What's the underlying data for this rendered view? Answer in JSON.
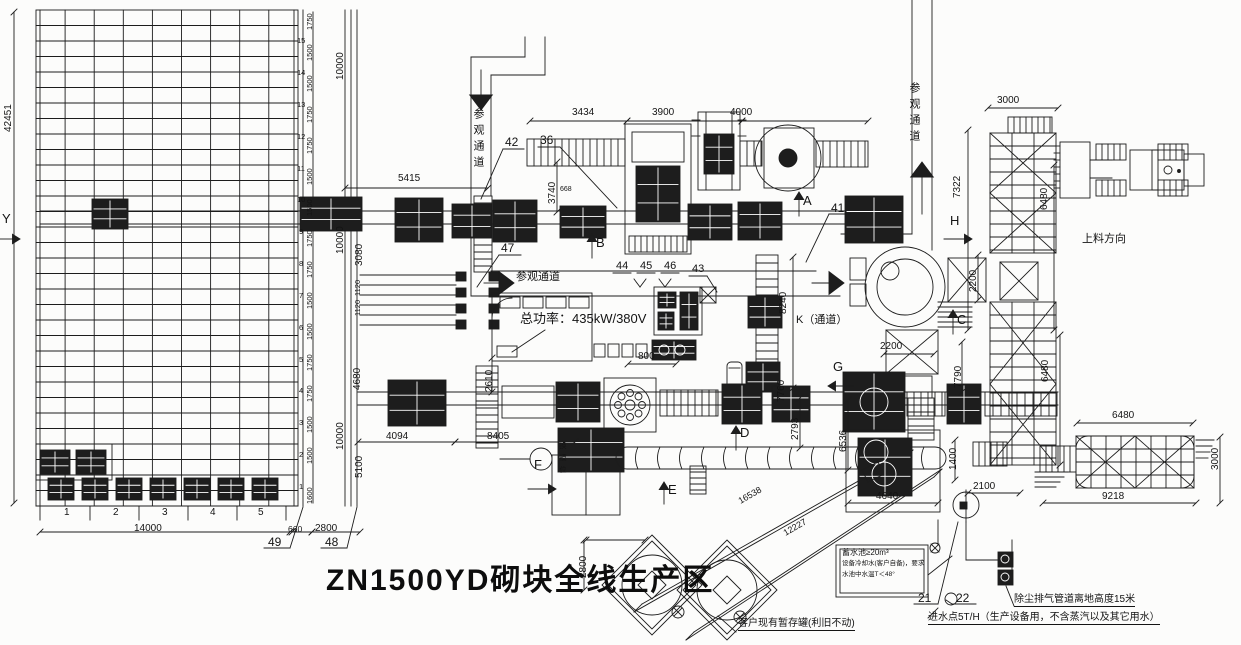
{
  "title": {
    "text": "ZN1500YD砌块全线生产区"
  },
  "colors": {
    "ink": "#1c1c1c",
    "paper": "#fcfcfb"
  },
  "annotations": [
    {
      "name": "dim-5415",
      "text": "5415",
      "x": 398,
      "y": 174
    },
    {
      "name": "dim-3434",
      "text": "3434",
      "x": 572,
      "y": 108
    },
    {
      "name": "dim-3900",
      "text": "3900",
      "x": 652,
      "y": 108
    },
    {
      "name": "dim-4000",
      "text": "4000",
      "x": 730,
      "y": 108
    },
    {
      "name": "dim-3000-top",
      "text": "3000",
      "x": 997,
      "y": 96
    },
    {
      "name": "dim-800",
      "text": "800",
      "x": 638,
      "y": 352
    },
    {
      "name": "dim-4094",
      "text": "4094",
      "x": 386,
      "y": 432
    },
    {
      "name": "dim-8405",
      "text": "8405",
      "x": 487,
      "y": 432
    },
    {
      "name": "dim-2200-h",
      "text": "2200",
      "x": 880,
      "y": 342
    },
    {
      "name": "dim-4640",
      "text": "4640",
      "x": 876,
      "y": 492
    },
    {
      "name": "dim-2100",
      "text": "2100",
      "x": 973,
      "y": 482
    },
    {
      "name": "dim-6480-h",
      "text": "6480",
      "x": 1112,
      "y": 411
    },
    {
      "name": "dim-9218",
      "text": "9218",
      "x": 1102,
      "y": 492
    },
    {
      "name": "dim-14000",
      "text": "14000",
      "x": 134,
      "y": 524
    },
    {
      "name": "dim-660",
      "text": "660",
      "x": 288,
      "y": 525,
      "size": 8.5
    },
    {
      "name": "dim-2800-b",
      "text": "2800",
      "x": 315,
      "y": 524
    },
    {
      "name": "dim-668",
      "text": "668",
      "x": 560,
      "y": 186,
      "size": 7
    },
    {
      "name": "dim-42451",
      "text": "42451",
      "x": 4,
      "y": 132,
      "rot": -90
    },
    {
      "name": "dim-3740",
      "text": "3740",
      "x": 548,
      "y": 204,
      "rot": -90
    },
    {
      "name": "dim-8240",
      "text": "8240",
      "x": 779,
      "y": 314,
      "rot": -90
    },
    {
      "name": "dim-7760",
      "text": "7760",
      "x": 777,
      "y": 402,
      "rot": -90
    },
    {
      "name": "dim-2793",
      "text": "2793",
      "x": 791,
      "y": 440,
      "rot": -90
    },
    {
      "name": "dim-6536",
      "text": "6536",
      "x": 839,
      "y": 452,
      "rot": -90
    },
    {
      "name": "dim-7790",
      "text": "7790",
      "x": 954,
      "y": 388,
      "rot": -90
    },
    {
      "name": "dim-2200-v",
      "text": "2200",
      "x": 969,
      "y": 292,
      "rot": -90
    },
    {
      "name": "dim-7322",
      "text": "7322",
      "x": 953,
      "y": 198,
      "rot": -90
    },
    {
      "name": "dim-6480-v1",
      "text": "6480",
      "x": 1040,
      "y": 210,
      "rot": -90
    },
    {
      "name": "dim-6480-v2",
      "text": "6480",
      "x": 1041,
      "y": 382,
      "rot": -90
    },
    {
      "name": "dim-3000-r",
      "text": "3000",
      "x": 1211,
      "y": 470,
      "rot": -90
    },
    {
      "name": "dim-1400",
      "text": "1400",
      "x": 949,
      "y": 470,
      "rot": -90
    },
    {
      "name": "dim-2610",
      "text": "2610",
      "x": 485,
      "y": 392,
      "rot": -90
    },
    {
      "name": "dim-2800-t",
      "text": "2800",
      "x": 579,
      "y": 578,
      "rot": -90
    },
    {
      "name": "dim-10000-1",
      "text": "10000",
      "x": 336,
      "y": 80,
      "rot": -90
    },
    {
      "name": "dim-10000-2",
      "text": "10000",
      "x": 336,
      "y": 254,
      "rot": -90
    },
    {
      "name": "dim-10000-3",
      "text": "10000",
      "x": 336,
      "y": 450,
      "rot": -90
    },
    {
      "name": "dim-3080",
      "text": "3080",
      "x": 355,
      "y": 266,
      "rot": -90
    },
    {
      "name": "dim-1120-1",
      "text": "1120",
      "x": 354,
      "y": 296,
      "rot": -90,
      "size": 7.5
    },
    {
      "name": "dim-1120-2",
      "text": "1120",
      "x": 354,
      "y": 316,
      "rot": -90,
      "size": 7.5
    },
    {
      "name": "dim-4680",
      "text": "4680",
      "x": 353,
      "y": 390,
      "rot": -90
    },
    {
      "name": "dim-5100",
      "text": "5100",
      "x": 355,
      "y": 478,
      "rot": -90
    },
    {
      "name": "callout-42",
      "text": "42",
      "x": 505,
      "y": 136,
      "size": 12
    },
    {
      "name": "callout-36",
      "text": "36",
      "x": 540,
      "y": 134,
      "size": 12
    },
    {
      "name": "callout-47",
      "text": "47",
      "x": 501,
      "y": 242,
      "size": 12
    },
    {
      "name": "callout-41",
      "text": "41",
      "x": 831,
      "y": 202,
      "size": 12
    },
    {
      "name": "callout-44",
      "text": "44",
      "x": 616,
      "y": 261,
      "size": 11
    },
    {
      "name": "callout-45",
      "text": "45",
      "x": 640,
      "y": 261,
      "size": 11
    },
    {
      "name": "callout-46",
      "text": "46",
      "x": 664,
      "y": 261,
      "size": 11
    },
    {
      "name": "callout-43",
      "text": "43",
      "x": 692,
      "y": 264,
      "size": 11
    },
    {
      "name": "callout-49",
      "text": "49",
      "x": 268,
      "y": 536,
      "size": 12
    },
    {
      "name": "callout-48",
      "text": "48",
      "x": 325,
      "y": 536,
      "size": 12
    },
    {
      "name": "callout-21",
      "text": "21",
      "x": 918,
      "y": 592,
      "size": 12
    },
    {
      "name": "callout-22",
      "text": "22",
      "x": 956,
      "y": 592,
      "size": 12
    },
    {
      "name": "section-Y",
      "text": "Y",
      "x": 2,
      "y": 212,
      "size": 13
    },
    {
      "name": "section-A",
      "text": "A",
      "x": 803,
      "y": 194,
      "size": 13
    },
    {
      "name": "section-B",
      "text": "B",
      "x": 596,
      "y": 236,
      "size": 13
    },
    {
      "name": "section-C",
      "text": "C",
      "x": 957,
      "y": 313,
      "size": 13
    },
    {
      "name": "section-D",
      "text": "D",
      "x": 740,
      "y": 426,
      "size": 13
    },
    {
      "name": "section-E",
      "text": "E",
      "x": 668,
      "y": 483,
      "size": 13
    },
    {
      "name": "section-F",
      "text": "F",
      "x": 534,
      "y": 458,
      "size": 13
    },
    {
      "name": "section-G",
      "text": "G",
      "x": 833,
      "y": 360,
      "size": 13
    },
    {
      "name": "section-H",
      "text": "H",
      "x": 950,
      "y": 214,
      "size": 13
    },
    {
      "name": "total-power-note",
      "text": "总功率：435kW/380V",
      "x": 520,
      "y": 312,
      "size": 13
    },
    {
      "name": "k-passage-label",
      "text": "K（通道）",
      "x": 796,
      "y": 315,
      "size": 11
    },
    {
      "name": "feeding-direction-label",
      "text": "上料方向",
      "x": 1082,
      "y": 234,
      "size": 11
    },
    {
      "name": "visitor-passage-label-mid",
      "text": "参观通道",
      "x": 516,
      "y": 272,
      "size": 11
    },
    {
      "name": "visitor-passage-label-top",
      "text": "参观通道",
      "x": 472,
      "y": 108,
      "size": 11,
      "vcn": true
    },
    {
      "name": "visitor-passage-label-right",
      "text": "参观通道",
      "x": 908,
      "y": 82,
      "size": 11,
      "vcn": true
    },
    {
      "name": "mold-change-label",
      "text": "换模位",
      "x": 559,
      "y": 442,
      "size": 7,
      "vcn": true
    },
    {
      "name": "existing-tank-note",
      "text": "客户现有暂存罐(利旧不动)",
      "x": 738,
      "y": 619,
      "size": 10,
      "u": true
    },
    {
      "name": "dust-exhaust-note",
      "text": "除尘排气管道离地高度15米",
      "x": 1014,
      "y": 595,
      "size": 10,
      "u": true
    },
    {
      "name": "water-inlet-note",
      "text": "进水点5T/H（生产设备用，不含蒸汽以及其它用水）",
      "x": 928,
      "y": 613,
      "size": 10,
      "u": true
    },
    {
      "name": "water-pool-note-line1",
      "text": "蓄水池≥20m³",
      "x": 842,
      "y": 549,
      "size": 8
    },
    {
      "name": "water-pool-note-line2",
      "text": "设备冷却水(客户自备)，要求",
      "x": 842,
      "y": 561,
      "size": 6.5
    },
    {
      "name": "water-pool-note-line3",
      "text": "水池中水温T＜48°",
      "x": 842,
      "y": 572,
      "size": 6.5
    },
    {
      "name": "screw-conveyor-dim-16538",
      "text": "16538",
      "x": 737,
      "y": 498,
      "size": 9,
      "rot": -30
    },
    {
      "name": "screw-conveyor-dim-12227",
      "text": "12227",
      "x": 782,
      "y": 530,
      "size": 9,
      "rot": -30
    },
    {
      "name": "bay-number",
      "text": "1",
      "x": 64,
      "y": 508
    },
    {
      "name": "bay-number",
      "text": "2",
      "x": 113,
      "y": 508
    },
    {
      "name": "bay-number",
      "text": "3",
      "x": 162,
      "y": 508
    },
    {
      "name": "bay-number",
      "text": "4",
      "x": 210,
      "y": 508
    },
    {
      "name": "bay-number",
      "text": "5",
      "x": 258,
      "y": 508
    },
    {
      "name": "rack-pitch-dim",
      "text": "1750",
      "x": 306,
      "y": 30,
      "rot": -90,
      "size": 7.5
    },
    {
      "name": "rack-pitch-dim",
      "text": "1500",
      "x": 306,
      "y": 61,
      "rot": -90,
      "size": 7.5
    },
    {
      "name": "rack-pitch-dim",
      "text": "1500",
      "x": 306,
      "y": 92,
      "rot": -90,
      "size": 7.5
    },
    {
      "name": "rack-pitch-dim",
      "text": "1750",
      "x": 306,
      "y": 123,
      "rot": -90,
      "size": 7.5
    },
    {
      "name": "rack-pitch-dim",
      "text": "1750",
      "x": 306,
      "y": 154,
      "rot": -90,
      "size": 7.5
    },
    {
      "name": "rack-pitch-dim",
      "text": "1500",
      "x": 306,
      "y": 185,
      "rot": -90,
      "size": 7.5
    },
    {
      "name": "rack-pitch-dim",
      "text": "1500",
      "x": 306,
      "y": 216,
      "rot": -90,
      "size": 7.5
    },
    {
      "name": "rack-pitch-dim",
      "text": "1750",
      "x": 306,
      "y": 247,
      "rot": -90,
      "size": 7.5
    },
    {
      "name": "rack-pitch-dim",
      "text": "1750",
      "x": 306,
      "y": 278,
      "rot": -90,
      "size": 7.5
    },
    {
      "name": "rack-pitch-dim",
      "text": "1500",
      "x": 306,
      "y": 309,
      "rot": -90,
      "size": 7.5
    },
    {
      "name": "rack-pitch-dim",
      "text": "1500",
      "x": 306,
      "y": 340,
      "rot": -90,
      "size": 7.5
    },
    {
      "name": "rack-pitch-dim",
      "text": "1750",
      "x": 306,
      "y": 371,
      "rot": -90,
      "size": 7.5
    },
    {
      "name": "rack-pitch-dim",
      "text": "1750",
      "x": 306,
      "y": 402,
      "rot": -90,
      "size": 7.5
    },
    {
      "name": "rack-pitch-dim",
      "text": "1500",
      "x": 306,
      "y": 433,
      "rot": -90,
      "size": 7.5
    },
    {
      "name": "rack-pitch-dim",
      "text": "1500",
      "x": 306,
      "y": 464,
      "rot": -90,
      "size": 7.5
    },
    {
      "name": "rack-pitch-dim",
      "text": "1600",
      "x": 306,
      "y": 504,
      "rot": -90,
      "size": 7.5
    },
    {
      "name": "rack-level-number",
      "text": "15",
      "x": 297,
      "y": 37,
      "size": 7.5
    },
    {
      "name": "rack-level-number",
      "text": "14",
      "x": 297,
      "y": 69,
      "size": 7.5
    },
    {
      "name": "rack-level-number",
      "text": "13",
      "x": 297,
      "y": 101,
      "size": 7.5
    },
    {
      "name": "rack-level-number",
      "text": "12",
      "x": 297,
      "y": 133,
      "size": 7.5
    },
    {
      "name": "rack-level-number",
      "text": "11",
      "x": 297,
      "y": 165,
      "size": 7.5
    },
    {
      "name": "rack-level-number",
      "text": "10",
      "x": 297,
      "y": 196,
      "size": 7.5
    },
    {
      "name": "rack-level-number",
      "text": "9",
      "x": 299,
      "y": 228,
      "size": 7.5
    },
    {
      "name": "rack-level-number",
      "text": "8",
      "x": 299,
      "y": 260,
      "size": 7.5
    },
    {
      "name": "rack-level-number",
      "text": "7",
      "x": 299,
      "y": 292,
      "size": 7.5
    },
    {
      "name": "rack-level-number",
      "text": "6",
      "x": 299,
      "y": 324,
      "size": 7.5
    },
    {
      "name": "rack-level-number",
      "text": "5",
      "x": 299,
      "y": 356,
      "size": 7.5
    },
    {
      "name": "rack-level-number",
      "text": "4",
      "x": 299,
      "y": 387,
      "size": 7.5
    },
    {
      "name": "rack-level-number",
      "text": "3",
      "x": 299,
      "y": 419,
      "size": 7.5
    },
    {
      "name": "rack-level-number",
      "text": "2",
      "x": 299,
      "y": 451,
      "size": 7.5
    },
    {
      "name": "rack-level-number",
      "text": "1",
      "x": 299,
      "y": 483,
      "size": 7.5
    }
  ]
}
